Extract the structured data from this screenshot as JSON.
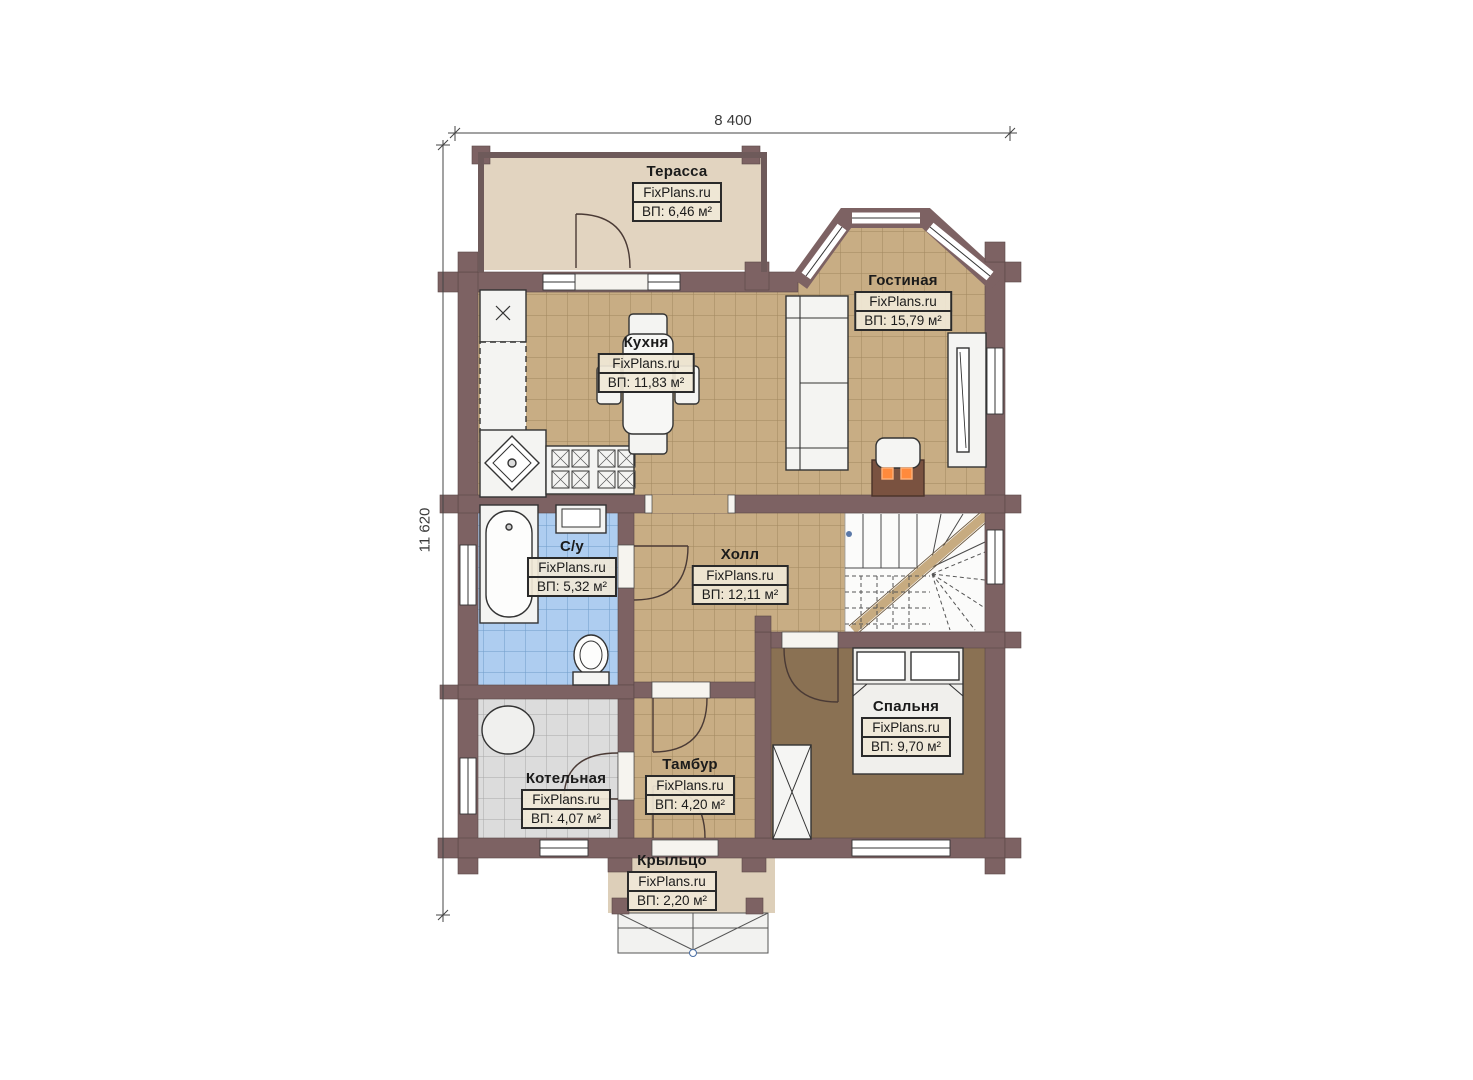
{
  "watermark": "FixPlans.ru",
  "dimensions": {
    "width_label": "8 400",
    "height_label": "11 620"
  },
  "rooms": [
    {
      "id": "terrace",
      "name": "Терасса",
      "area": "ВП: 6,46 м²"
    },
    {
      "id": "kitchen",
      "name": "Кухня",
      "area": "ВП: 11,83 м²"
    },
    {
      "id": "living",
      "name": "Гостиная",
      "area": "ВП: 15,79 м²"
    },
    {
      "id": "bathroom",
      "name": "С/у",
      "area": "ВП: 5,32 м²"
    },
    {
      "id": "hall",
      "name": "Холл",
      "area": "ВП: 12,11 м²"
    },
    {
      "id": "bedroom",
      "name": "Спальня",
      "area": "ВП: 9,70 м²"
    },
    {
      "id": "boiler",
      "name": "Котельная",
      "area": "ВП: 4,07 м²"
    },
    {
      "id": "tambour",
      "name": "Тамбур",
      "area": "ВП: 4,20 м²"
    },
    {
      "id": "porch",
      "name": "Крыльцо",
      "area": "ВП: 2,20 м²"
    }
  ],
  "marks": {
    "counter_x": "×"
  },
  "colors": {
    "wall": "#7d6263",
    "tile_floor": "#c8ad84",
    "bath_tile": "#aecdf0",
    "boiler_tile": "#dcdcdc",
    "bedroom_floor": "#8a7153",
    "terrace_floor": "#e2d4c0",
    "porch_floor": "#ddcfb9",
    "fireplace_accent": "#ff8a3c"
  }
}
